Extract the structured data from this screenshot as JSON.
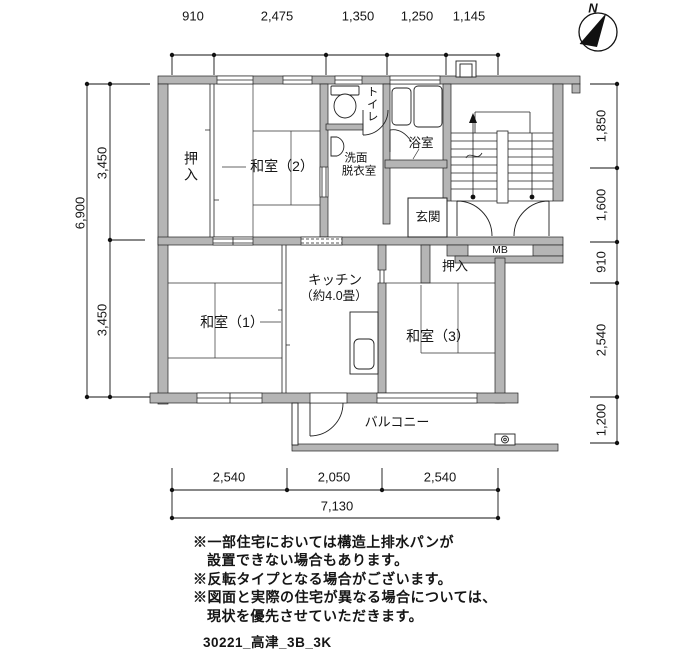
{
  "compass": {
    "north_label": "N"
  },
  "dimensions": {
    "top": [
      "910",
      "2,475",
      "1,350",
      "1,250",
      "1,145"
    ],
    "left_inner": [
      "3,450",
      "3,450"
    ],
    "left_outer": "6,900",
    "right": [
      "1,850",
      "1,600",
      "910",
      "2,540",
      "1,200"
    ],
    "bottom_inner": [
      "2,540",
      "2,050",
      "2,540"
    ],
    "bottom_total": "7,130"
  },
  "rooms": {
    "oshiire_upper": "押入",
    "washitsu2": "和室（2）",
    "toilet": "トイレ",
    "washroom_line1": "洗面",
    "washroom_line2": "脱衣室",
    "bath": "浴室",
    "genkan": "玄関",
    "meter_box": "MB",
    "kitchen_line1": "キッチン",
    "kitchen_line2": "（約4.0畳）",
    "washitsu1": "和室（1）",
    "oshiire_lower": "押入",
    "washitsu3": "和室（3）",
    "balcony": "バルコニー"
  },
  "notes": {
    "line1": "※一部住宅においては構造上排水パンが",
    "line2": "設置できない場合もあります。",
    "line3": "※反転タイプとなる場合がございます。",
    "line4": "※図面と実際の住宅が異なる場合については、",
    "line5": "現状を優先させていただきます。",
    "drawing_code": "30221_高津_3B_3K"
  }
}
